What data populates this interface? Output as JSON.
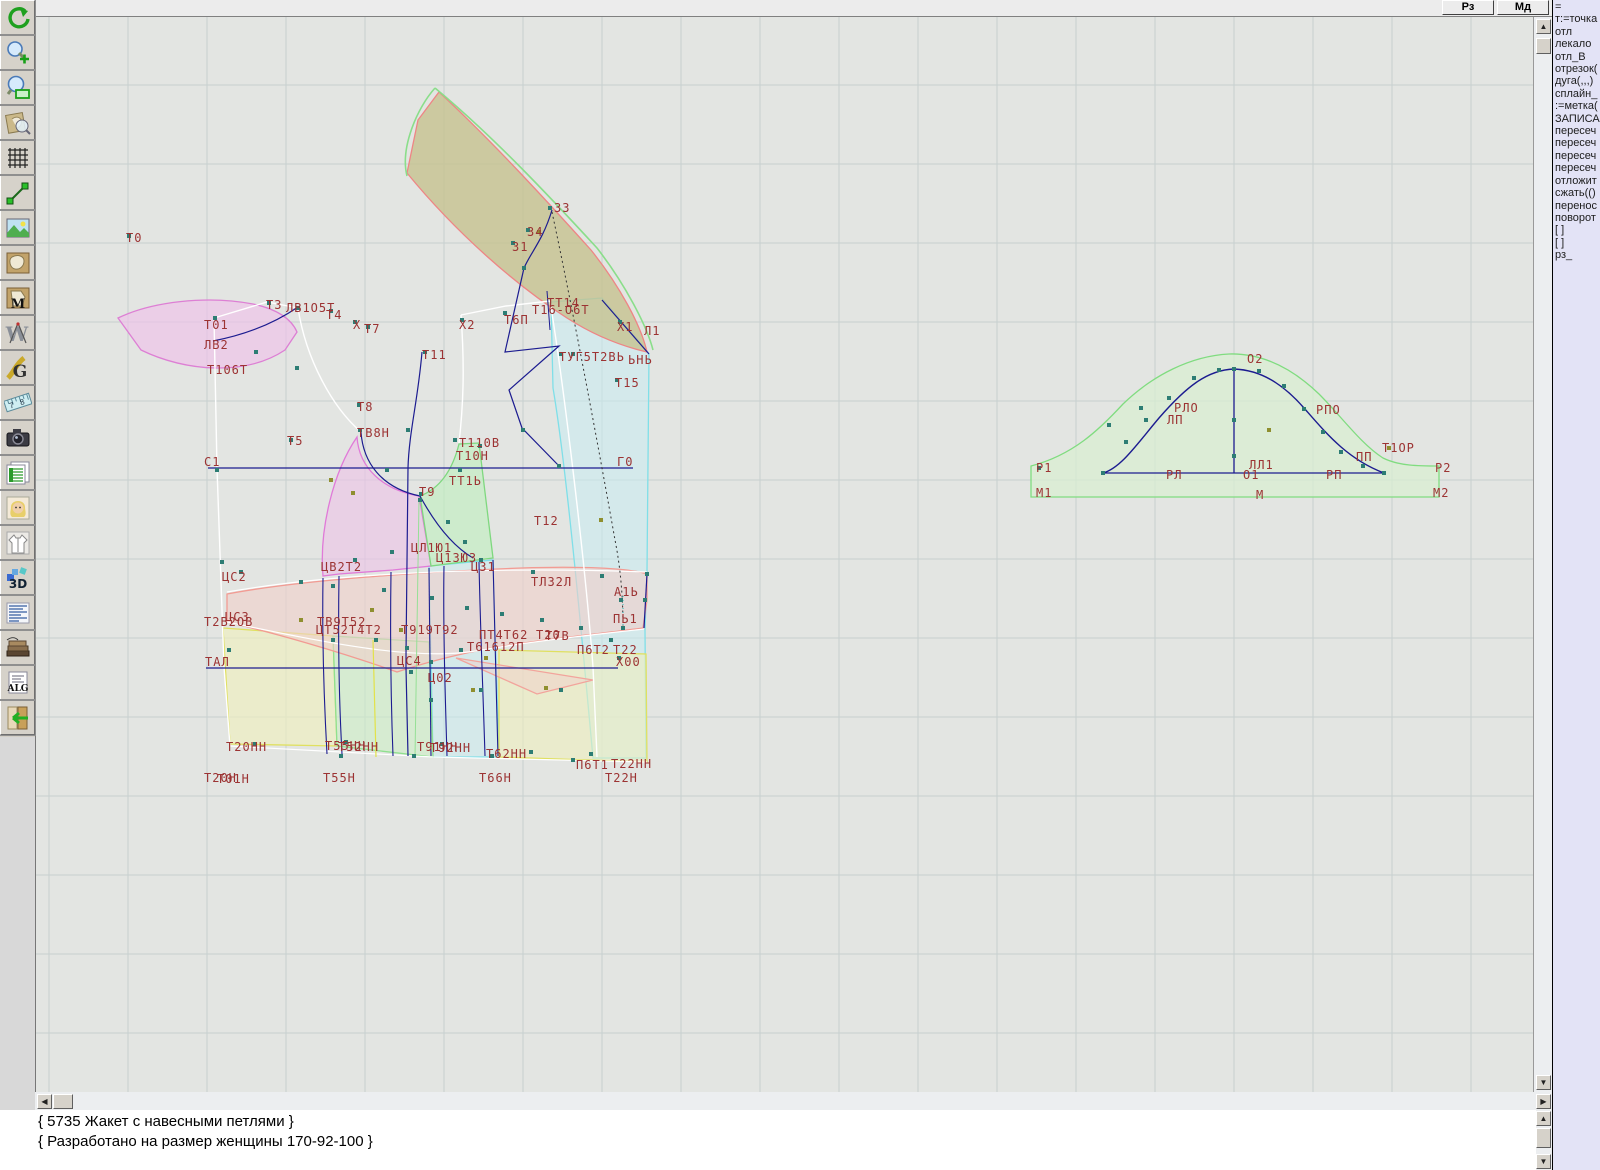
{
  "topbar": {
    "buttons": [
      {
        "label": "Рз"
      },
      {
        "label": "Мд"
      }
    ]
  },
  "toolbar": {
    "buttons": [
      {
        "icon": "undo"
      },
      {
        "icon": "zoom-in"
      },
      {
        "icon": "zoom-window"
      },
      {
        "icon": "preview-zoom"
      },
      {
        "icon": "grid"
      },
      {
        "icon": "segment"
      },
      {
        "icon": "image"
      },
      {
        "icon": "pattern"
      },
      {
        "icon": "pattern-m"
      },
      {
        "icon": "compass"
      },
      {
        "icon": "g-doc"
      },
      {
        "icon": "ruler"
      },
      {
        "icon": "camera"
      },
      {
        "icon": "table"
      },
      {
        "icon": "portrait"
      },
      {
        "icon": "garment"
      },
      {
        "icon": "3d"
      },
      {
        "icon": "text-block"
      },
      {
        "icon": "books"
      },
      {
        "icon": "alg"
      },
      {
        "icon": "exit"
      }
    ]
  },
  "side_panel": {
    "lines": [
      "=",
      "т:=точка",
      "отл",
      "лекало",
      "отл_В",
      "отрезок(",
      "дуга(,,,)",
      "сплайн_",
      ":=метка(",
      "ЗАПИСА",
      "пересеч",
      "пересеч",
      "пересеч",
      "пересеч",
      "отложит",
      "сжать(()",
      "перенос",
      "поворот",
      "[ ]",
      "[ ]",
      "рз_"
    ]
  },
  "status": {
    "line1": "{ 5735 Жакет с навесными петлями }",
    "line2": "{ Разработано на размер женщины 170-92-100 }"
  },
  "canvas": {
    "background": "#e3e5e2",
    "grid": {
      "step": 79,
      "x0": 48,
      "y0": 6,
      "color": "#c7d0cf"
    },
    "pieces": [
      {
        "name": "front-edge-band-cyan",
        "d": "M550,302 L601,298 C622,324 640,342 648,354 L646,572 L644,630 L645,758 L592,758 C582,650 566,470 552,388 Z",
        "fill": "#c8edf2",
        "stroke": "#7fdfe8",
        "opacity": 0.55
      },
      {
        "name": "mid-panel-cyan",
        "d": "M428,566 L492,560 L498,757 L432,757 Z",
        "fill": "#c8edf2",
        "stroke": "#7fdfe8",
        "opacity": 0.5
      },
      {
        "name": "hem-band-yellow-left",
        "d": "M222,628 L332,636 L336,746 L229,744 Z",
        "fill": "#efefbe",
        "stroke": "#e0e060",
        "opacity": 0.65
      },
      {
        "name": "hem-band-green",
        "d": "M332,636 L428,642 L432,757 L336,746 Z",
        "fill": "#cdeec6",
        "stroke": "#8fe08f",
        "opacity": 0.6
      },
      {
        "name": "hem-band-yellow-right",
        "d": "M498,650 L645,654 L646,762 L498,757 Z",
        "fill": "#efefbe",
        "stroke": "#e0e060",
        "opacity": 0.6
      },
      {
        "name": "collar-band-olive",
        "d": "M438,92 C490,140 545,200 590,250 C618,285 640,325 646,352 C620,346 594,336 566,318 C516,286 456,234 406,173 L417,120 Z",
        "fill": "#c6c290",
        "stroke": "#ee8585",
        "opacity": 0.8
      },
      {
        "name": "collar-crescent-pink",
        "d": "M117,318 C150,302 205,295 252,304 C275,309 290,318 296,332 L284,350 C245,376 185,372 140,350 Z",
        "fill": "#f0c0ea",
        "stroke": "#dd7fd4",
        "opacity": 0.62
      },
      {
        "name": "side-panel-magenta",
        "d": "M356,437 C358,468 382,490 418,496 L430,566 L392,570 L338,574 L322,576 C318,530 332,472 356,437 Z",
        "fill": "#edc2e8",
        "stroke": "#e07ad8",
        "opacity": 0.6
      },
      {
        "name": "underarm-quad-green",
        "d": "M419,496 C440,488 452,468 458,444 L478,443 L492,558 L430,566 Z",
        "fill": "#c2eec0",
        "stroke": "#7fd87f",
        "opacity": 0.65
      },
      {
        "name": "waist-belt-salmon",
        "d": "M226,594 C300,580 420,572 520,568 C580,566 628,568 646,574 L646,600 L642,628 C580,636 520,642 480,650 C450,656 420,664 396,672 C340,652 270,632 226,622 Z",
        "fill": "#f0cfc9",
        "stroke": "#f29b93",
        "opacity": 0.6
      },
      {
        "name": "waist-dart-salmon",
        "d": "M455,658 L592,680 L536,694 Z",
        "fill": "#f0cfc9",
        "stroke": "#f2a49c",
        "opacity": 0.5
      },
      {
        "name": "sleeve-cap-green",
        "d": "M1030,497 L1030,466 C1072,455 1098,430 1122,404 C1152,375 1190,356 1228,354 C1262,353 1292,369 1318,394 C1340,416 1360,444 1382,458 C1398,466 1418,466 1438,466 L1438,497 Z",
        "fill": "#d8efd2",
        "stroke": "#80dc80",
        "opacity": 0.7
      }
    ],
    "lines": [
      {
        "d": "M213,318 L216,468 L223,667 L229,746",
        "s": "#ffffff",
        "w": 1.4
      },
      {
        "d": "M213,318 L266,302 L297,308",
        "s": "#ffffff",
        "w": 1.4
      },
      {
        "d": "M460,315 L505,306 L549,301",
        "s": "#ffffff",
        "w": 1.4
      },
      {
        "d": "M549,301 C562,380 584,560 592,667 L596,757",
        "s": "#ffffff",
        "w": 1.4
      },
      {
        "d": "M297,308 C305,360 332,408 360,432",
        "s": "#ffffff",
        "w": 1.4
      },
      {
        "d": "M460,315 C464,370 462,408 458,443",
        "s": "#ffffff",
        "w": 1.4
      },
      {
        "d": "M226,592 C330,574 480,566 646,572",
        "s": "#ffffff",
        "w": 1.2
      },
      {
        "d": "M226,622 C330,644 420,662 480,650 C540,640 600,634 643,629",
        "s": "#ffffff",
        "w": 1.2
      },
      {
        "d": "M229,746 L432,757 L646,762",
        "s": "#ffffff",
        "w": 1.2
      },
      {
        "d": "M434,88 C492,136 550,198 596,248 C624,284 646,326 652,350",
        "s": "#8ade8a",
        "w": 1.6
      },
      {
        "d": "M406,176 C399,148 416,108 434,88",
        "s": "#8ade8a",
        "w": 1.6
      },
      {
        "d": "M372,640 L375,757",
        "s": "#e2e24a",
        "w": 1.2
      },
      {
        "d": "M418,500 L414,757",
        "s": "#96e096",
        "w": 1
      },
      {
        "d": "M207,468 L632,468",
        "s": "#1c1c90",
        "w": 1.3
      },
      {
        "d": "M205,668 L617,668",
        "s": "#1c1c90",
        "w": 1.3
      },
      {
        "d": "M421,352 C417,400 408,432 407,468 C406,560 405,612 405,668 L407,756",
        "s": "#1c1c90",
        "w": 1.2
      },
      {
        "d": "M360,432 C362,462 380,488 419,496",
        "s": "#1c1c90",
        "w": 1.2
      },
      {
        "d": "M297,307 C268,327 238,336 212,341",
        "s": "#1c1c90",
        "w": 1.2
      },
      {
        "d": "M551,210 C542,240 530,252 523,268 L504,352 L558,346 L508,390 L521,428 L560,468",
        "s": "#1c1c90",
        "w": 1.2
      },
      {
        "d": "M546,291 L549,330",
        "s": "#1c1c90",
        "w": 1
      },
      {
        "d": "M601,300 L648,354",
        "s": "#1c1c90",
        "w": 1.2
      },
      {
        "d": "M419,496 C432,520 450,545 472,558",
        "s": "#1c1c90",
        "w": 1.2
      },
      {
        "d": "M646,574 L643,628",
        "s": "#1c1c90",
        "w": 1.2
      },
      {
        "d": "M322,578 C321,640 323,700 326,754",
        "s": "#1c1c90",
        "w": 1.1
      },
      {
        "d": "M338,576 C337,640 338,700 341,754",
        "s": "#1c1c90",
        "w": 1.1
      },
      {
        "d": "M390,572 C389,640 390,702 392,756",
        "s": "#1c1c90",
        "w": 1.1
      },
      {
        "d": "M428,568 L430,756",
        "s": "#1c1c90",
        "w": 1.1
      },
      {
        "d": "M443,566 C442,620 444,690 446,756",
        "s": "#1c1c90",
        "w": 1.1
      },
      {
        "d": "M478,562 C479,620 482,690 484,756",
        "s": "#1c1c90",
        "w": 1.1
      },
      {
        "d": "M492,560 C494,620 495,690 497,756",
        "s": "#1c1c90",
        "w": 1.1
      },
      {
        "d": "M551,212 C572,310 598,450 614,540 C620,570 622,600 622,628",
        "s": "#333333",
        "w": 1,
        "dash": "2,3"
      },
      {
        "d": "M622,596 L622,626",
        "s": "#49c3c3",
        "w": 1.2,
        "dash": "1,3"
      },
      {
        "d": "M1102,473 C1120,468 1136,444 1158,418 C1185,387 1206,370 1233,369 C1260,370 1282,384 1303,408 C1325,433 1346,459 1383,473",
        "s": "#1c1c90",
        "w": 1.4
      },
      {
        "d": "M1233,369 L1233,473",
        "s": "#1c1c90",
        "w": 1.3
      },
      {
        "d": "M1102,473 L1383,473",
        "s": "#1c1c90",
        "w": 1.3
      }
    ],
    "labels": [
      [
        "Т0",
        125,
        231
      ],
      [
        "Т01",
        203,
        318
      ],
      [
        "ЛВ2",
        203,
        338
      ],
      [
        "Т106Т",
        206,
        363
      ],
      [
        "Т3",
        265,
        298
      ],
      [
        "ЛВ1О5Т",
        285,
        301
      ],
      [
        "Т4",
        325,
        308
      ],
      [
        "Х",
        352,
        318
      ],
      [
        "Т7",
        363,
        322
      ],
      [
        "Т5",
        286,
        434
      ],
      [
        "Т11",
        421,
        348
      ],
      [
        "Х2",
        458,
        318
      ],
      [
        "Т6П",
        503,
        313
      ],
      [
        "ТТ14",
        546,
        296
      ],
      [
        "Т16-О6Т",
        531,
        303
      ],
      [
        "33",
        553,
        201
      ],
      [
        "34",
        526,
        225
      ],
      [
        "31",
        511,
        240
      ],
      [
        "Х1",
        616,
        320
      ],
      [
        "Л1",
        643,
        324
      ],
      [
        "ТУГ5Т2ВЬ",
        558,
        350
      ],
      [
        "ЬНЬ",
        627,
        353
      ],
      [
        "Т15",
        614,
        376
      ],
      [
        "Т8",
        356,
        400
      ],
      [
        "ТВ8Н",
        356,
        426
      ],
      [
        "Т110В",
        458,
        436
      ],
      [
        "Т10Н",
        455,
        449
      ],
      [
        "С1",
        203,
        455
      ],
      [
        "Г0",
        616,
        455
      ],
      [
        "ТТ1Ь",
        448,
        474
      ],
      [
        "Т9",
        418,
        485
      ],
      [
        "Т12",
        533,
        514
      ],
      [
        "ЦЛ1Ю1",
        410,
        541
      ],
      [
        "Ц13Ю3",
        435,
        551
      ],
      [
        "Ц31",
        470,
        560
      ],
      [
        "ЦС2",
        221,
        570
      ],
      [
        "ЦВ2Т2",
        320,
        560
      ],
      [
        "ТЛ32Л",
        530,
        575
      ],
      [
        "А1Ь",
        613,
        585
      ],
      [
        "ПЬ1",
        612,
        612
      ],
      [
        "ЦС3",
        224,
        610
      ],
      [
        "Т2В2ОВ",
        203,
        615
      ],
      [
        "ТВ9Т52",
        316,
        615
      ],
      [
        "ЦТ52Т4Т2",
        315,
        623
      ],
      [
        "Т919Т92",
        400,
        623
      ],
      [
        "ПТ4Т62",
        478,
        628
      ],
      [
        "Т20",
        535,
        628
      ],
      [
        "Т7В",
        544,
        629
      ],
      [
        "Т61612П",
        466,
        640
      ],
      [
        "П6Т2",
        576,
        643
      ],
      [
        "Т22",
        612,
        643
      ],
      [
        "Х00",
        615,
        655
      ],
      [
        "ТАЛ",
        204,
        655
      ],
      [
        "ЦС4",
        396,
        654
      ],
      [
        "Ц02",
        427,
        671
      ],
      [
        "Т20НН",
        225,
        740
      ],
      [
        "Т55НН",
        324,
        739
      ],
      [
        "Т52НН",
        337,
        740
      ],
      [
        "Т91НН",
        416,
        740
      ],
      [
        "Т92НН",
        429,
        741
      ],
      [
        "Т62НН",
        485,
        747
      ],
      [
        "П6Т1",
        575,
        758
      ],
      [
        "Т22НН",
        610,
        757
      ],
      [
        "Т20Н",
        203,
        771
      ],
      [
        "Т01Н",
        216,
        772
      ],
      [
        "Т55Н",
        322,
        771
      ],
      [
        "Т66Н",
        478,
        771
      ],
      [
        "Т22Н",
        604,
        771
      ],
      [
        "О2",
        1246,
        352
      ],
      [
        "РЛО",
        1173,
        401
      ],
      [
        "ЛП",
        1166,
        413
      ],
      [
        "РПО",
        1315,
        403
      ],
      [
        "Т1ОР",
        1381,
        441
      ],
      [
        "ПП",
        1355,
        450
      ],
      [
        "Р1",
        1035,
        461
      ],
      [
        "РЛ",
        1165,
        468
      ],
      [
        "ЛЛ1",
        1248,
        458
      ],
      [
        "О1",
        1242,
        468
      ],
      [
        "РП",
        1325,
        468
      ],
      [
        "Р2",
        1434,
        461
      ],
      [
        "М1",
        1035,
        486
      ],
      [
        "М",
        1255,
        488
      ],
      [
        "М2",
        1432,
        486
      ]
    ],
    "markers": {
      "teal": {
        "color": "#2d7d74",
        "size": 4,
        "points": [
          [
            128,
            236
          ],
          [
            214,
            318
          ],
          [
            268,
            303
          ],
          [
            297,
            308
          ],
          [
            255,
            352
          ],
          [
            296,
            368
          ],
          [
            330,
            311
          ],
          [
            354,
            322
          ],
          [
            367,
            327
          ],
          [
            290,
            440
          ],
          [
            424,
            352
          ],
          [
            461,
            320
          ],
          [
            504,
            313
          ],
          [
            549,
            208
          ],
          [
            523,
            268
          ],
          [
            512,
            243
          ],
          [
            527,
            230
          ],
          [
            619,
            322
          ],
          [
            560,
            354
          ],
          [
            572,
            354
          ],
          [
            616,
            380
          ],
          [
            522,
            430
          ],
          [
            558,
            466
          ],
          [
            358,
            405
          ],
          [
            359,
            430
          ],
          [
            454,
            440
          ],
          [
            459,
            470
          ],
          [
            420,
            494
          ],
          [
            479,
            446
          ],
          [
            419,
            500
          ],
          [
            447,
            522
          ],
          [
            464,
            542
          ],
          [
            480,
            560
          ],
          [
            532,
            572
          ],
          [
            601,
            576
          ],
          [
            620,
            600
          ],
          [
            622,
            628
          ],
          [
            240,
            572
          ],
          [
            300,
            582
          ],
          [
            332,
            586
          ],
          [
            383,
            590
          ],
          [
            431,
            598
          ],
          [
            466,
            608
          ],
          [
            501,
            614
          ],
          [
            541,
            620
          ],
          [
            580,
            628
          ],
          [
            610,
            640
          ],
          [
            430,
            662
          ],
          [
            332,
            640
          ],
          [
            254,
            744
          ],
          [
            345,
            742
          ],
          [
            441,
            744
          ],
          [
            530,
            752
          ],
          [
            572,
            760
          ],
          [
            618,
            658
          ],
          [
            216,
            470
          ],
          [
            221,
            562
          ],
          [
            228,
            650
          ],
          [
            386,
            470
          ],
          [
            391,
            552
          ],
          [
            406,
            648
          ],
          [
            413,
            756
          ],
          [
            340,
            756
          ],
          [
            491,
            756
          ],
          [
            590,
            754
          ],
          [
            646,
            574
          ],
          [
            644,
            600
          ],
          [
            410,
            672
          ],
          [
            354,
            560
          ],
          [
            407,
            430
          ],
          [
            460,
            650
          ],
          [
            375,
            640
          ],
          [
            560,
            690
          ],
          [
            480,
            690
          ],
          [
            430,
            700
          ],
          [
            1102,
            473
          ],
          [
            1125,
            442
          ],
          [
            1145,
            420
          ],
          [
            1168,
            398
          ],
          [
            1193,
            378
          ],
          [
            1218,
            370
          ],
          [
            1233,
            369
          ],
          [
            1233,
            420
          ],
          [
            1233,
            456
          ],
          [
            1258,
            371
          ],
          [
            1283,
            386
          ],
          [
            1303,
            409
          ],
          [
            1322,
            432
          ],
          [
            1340,
            452
          ],
          [
            1362,
            466
          ],
          [
            1383,
            473
          ],
          [
            1038,
            468
          ],
          [
            1140,
            408
          ],
          [
            1108,
            425
          ]
        ]
      },
      "olive": {
        "color": "#8f8f2f",
        "size": 4,
        "points": [
          [
            538,
            232
          ],
          [
            352,
            493
          ],
          [
            330,
            480
          ],
          [
            400,
            630
          ],
          [
            485,
            658
          ],
          [
            545,
            688
          ],
          [
            300,
            620
          ],
          [
            371,
            610
          ],
          [
            472,
            690
          ],
          [
            600,
            520
          ],
          [
            1268,
            430
          ],
          [
            1388,
            448
          ]
        ]
      }
    }
  }
}
